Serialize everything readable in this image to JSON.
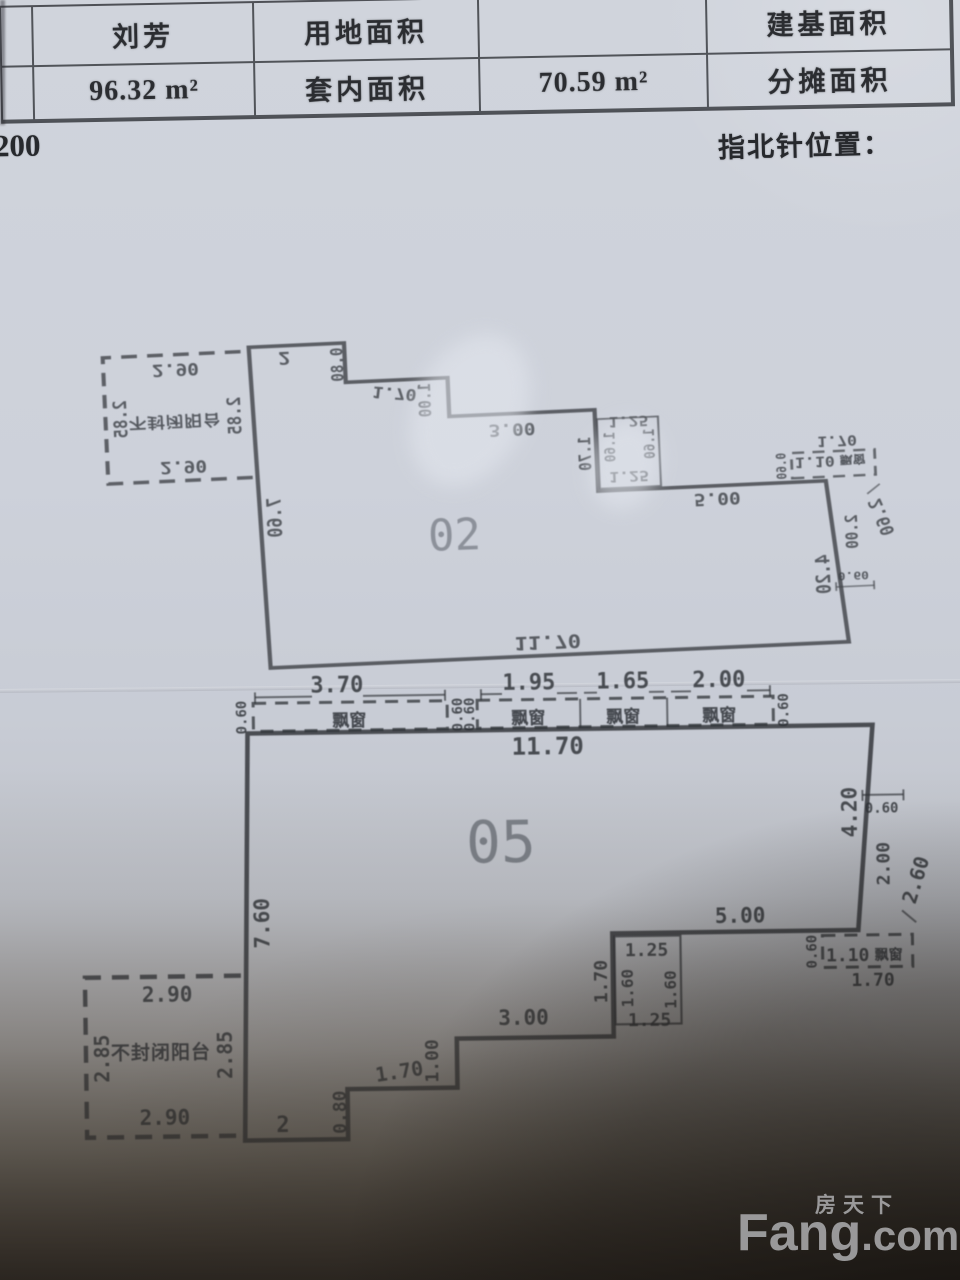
{
  "table": {
    "row1": {
      "c1": "刘芳",
      "c2": "用地面积",
      "c3": "",
      "c4": "建基面积"
    },
    "row2": {
      "c1": "96.32 m²",
      "c2": "套内面积",
      "c3": "70.59 m²",
      "c4": "分摊面积"
    }
  },
  "scale_fragment": "200",
  "compass_label": "指北针位置：",
  "plan": {
    "upper_unit_number": "02",
    "lower_unit_number": "05",
    "bay_strip": {
      "dims": [
        "3.70",
        "1.95",
        "1.65",
        "2.00"
      ],
      "depth": "0.60",
      "window_label": "飘窗"
    },
    "body": {
      "top_width": "11.70",
      "left_height": "7.60",
      "right_height_top": "4.20",
      "right_offset": "0.60",
      "right_height_mid": "2.00",
      "right_height_overall": "2.60",
      "bottom_right_width": "5.00",
      "br_bay_offset": "0.60",
      "br_bay_width": "1.10",
      "br_bay_label": "飘窗",
      "br_bay_total": "1.70",
      "notch_top": "1.25",
      "notch_left_outer": "1.70",
      "notch_left_inner": "1.60",
      "notch_right_inner": "1.60",
      "notch_bottom": "1.25",
      "bottom_width_1": "3.00",
      "bottom_step_1": "1.00",
      "bottom_width_2": "1.70",
      "bottom_step_2": "0.80",
      "bottom_width_3": "2",
      "balcony": {
        "top": "2.90",
        "left": "2.85",
        "label": "不封闭阳台",
        "right": "2.85",
        "bottom": "2.90"
      }
    }
  },
  "watermark": {
    "cn": "房天下",
    "en_main": "Fang",
    "en_suffix": ".com"
  }
}
